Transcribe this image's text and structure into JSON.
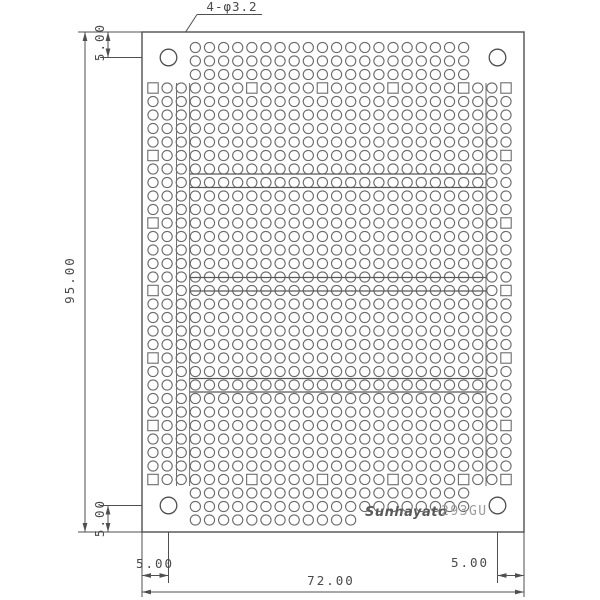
{
  "drawing": {
    "title_hole_spec": "4-φ3.2",
    "dimensions": {
      "board_height_mm": "95.00",
      "board_width_mm": "72.00",
      "hole_offset_top_mm": "5.00",
      "hole_offset_bottom_mm": "5.00",
      "hole_offset_left_mm": "5.00",
      "hole_offset_right_mm": "5.00"
    },
    "logo": {
      "brand": "Sunhayato",
      "model": "293GU"
    },
    "colors": {
      "background": "#ffffff",
      "line": "#4f4f4f",
      "pad": "#6b6b6b",
      "bus_line": "#585858",
      "logo_gray": "#9a9a9a"
    }
  }
}
